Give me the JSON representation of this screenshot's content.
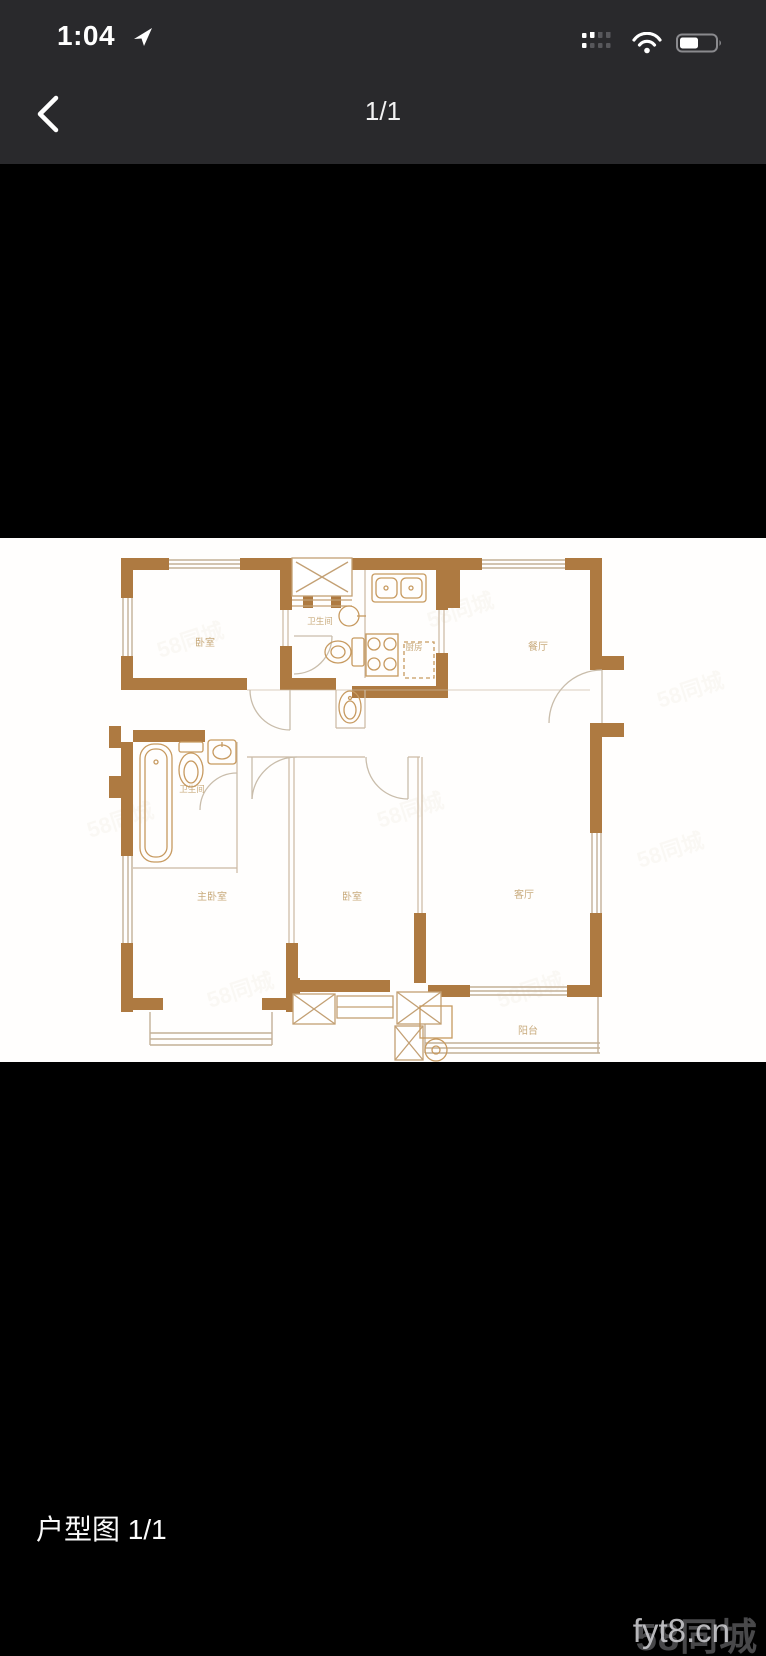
{
  "status_bar": {
    "time": "1:04"
  },
  "nav": {
    "page_indicator": "1/1"
  },
  "photo": {
    "rooms": {
      "bedroom_top": "卧室",
      "bath_top": "卫生间",
      "kitchen": "厨房",
      "dining": "餐厅",
      "bath_left": "卫生间",
      "master_bedroom": "主卧室",
      "bedroom_mid": "卧室",
      "living": "客厅",
      "balcony": "阳台"
    },
    "tiled_watermark": "58同城"
  },
  "caption": "户型图 1/1",
  "watermark": {
    "site": "fyt8.cn",
    "brand": "58同城"
  },
  "colors": {
    "wall": "#ae7a41",
    "header_bg": "#29292c",
    "label": "#bf9c66"
  }
}
